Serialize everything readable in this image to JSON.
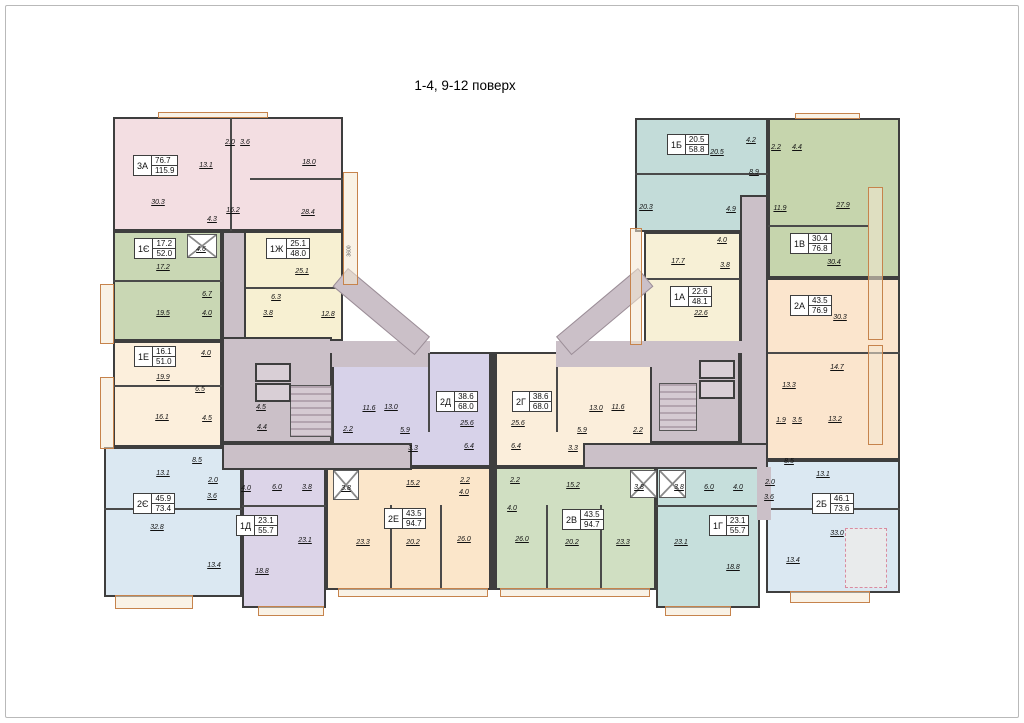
{
  "title": "1-4, 9-12 поверх",
  "palette": {
    "walls": "#3e3e3e",
    "corridor": "#cbc0c8",
    "balcony_outline": "#c6834c",
    "background": "#ffffff",
    "apt_3A": "#f3dee2",
    "apt_1E_ye": "#c9d7b4",
    "apt_1Zh": "#f7f0d2",
    "apt_1E": "#fcefdc",
    "apt_2E_ye": "#dbe8f2",
    "apt_1D": "#dcd4e8",
    "apt_2E": "#fbe6ca",
    "apt_2D": "#d7d2e9",
    "apt_2G": "#fbeedb",
    "apt_2V": "#d0dfc2",
    "apt_1G": "#c6dfdc",
    "apt_2B": "#dbe8f2",
    "apt_1B": "#c3dcd9",
    "apt_1V": "#c6d5ad",
    "apt_1A": "#f7f0d6",
    "apt_2A": "#fbe5cd"
  },
  "corridor": {
    "left_labels": [
      "4.5",
      "4.4"
    ]
  },
  "dimensions": {
    "vertical": "3600"
  },
  "apartments": [
    {
      "code": "3А",
      "area1": "76.7",
      "area2": "115.9",
      "color": "#f3dee2",
      "rooms": [
        "30.3",
        "13.1",
        "2.0",
        "3.6",
        "18.0",
        "16.2",
        "4.3",
        "28.4"
      ]
    },
    {
      "code": "1Є",
      "area1": "17.2",
      "area2": "52.0",
      "color": "#c9d7b4",
      "rooms": [
        "17.2",
        "4.6",
        "6.7",
        "19.5",
        "4.0"
      ]
    },
    {
      "code": "1Ж",
      "area1": "25.1",
      "area2": "48.0",
      "color": "#f7f0d2",
      "rooms": [
        "25.1",
        "6.3",
        "3.8",
        "12.8"
      ]
    },
    {
      "code": "1Е",
      "area1": "16.1",
      "area2": "51.0",
      "color": "#fcefdc",
      "rooms": [
        "4.0",
        "19.9",
        "6.5",
        "16.1",
        "4.5"
      ]
    },
    {
      "code": "2Є",
      "area1": "45.9",
      "area2": "73.4",
      "color": "#dbe8f2",
      "rooms": [
        "8.5",
        "13.1",
        "2.0",
        "3.6",
        "32.8",
        "13.4"
      ]
    },
    {
      "code": "1Д",
      "area1": "23.1",
      "area2": "55.7",
      "color": "#dcd4e8",
      "rooms": [
        "4.0",
        "6.0",
        "3.8",
        "23.1",
        "18.8"
      ]
    },
    {
      "code": "2Е",
      "area1": "43.5",
      "area2": "94.7",
      "color": "#fbe6ca",
      "rooms": [
        "3.8",
        "15.2",
        "2.2",
        "4.0",
        "23.3",
        "20.2",
        "26.0"
      ]
    },
    {
      "code": "2Д",
      "area1": "38.6",
      "area2": "68.0",
      "color": "#d7d2e9",
      "rooms": [
        "11.6",
        "13.0",
        "2.2",
        "5.9",
        "3.3",
        "25.6",
        "6.4"
      ]
    },
    {
      "code": "2Г",
      "area1": "38.6",
      "area2": "68.0",
      "color": "#fbeedb",
      "rooms": [
        "25.6",
        "6.4",
        "5.9",
        "3.3",
        "13.0",
        "11.6",
        "2.2"
      ]
    },
    {
      "code": "2В",
      "area1": "43.5",
      "area2": "94.7",
      "color": "#d0dfc2",
      "rooms": [
        "2.2",
        "4.0",
        "26.0",
        "15.2",
        "20.2",
        "23.3",
        "3.8"
      ]
    },
    {
      "code": "1Г",
      "area1": "23.1",
      "area2": "55.7",
      "color": "#c6dfdc",
      "rooms": [
        "3.8",
        "6.0",
        "4.0",
        "23.1",
        "18.8"
      ]
    },
    {
      "code": "2Б",
      "area1": "46.1",
      "area2": "73.6",
      "color": "#dbe8f2",
      "rooms": [
        "8.5",
        "13.1",
        "2.0",
        "3.6",
        "33.0",
        "13.4"
      ]
    },
    {
      "code": "1Б",
      "area1": "20.5",
      "area2": "58.8",
      "color": "#c3dcd9",
      "rooms": [
        "20.5",
        "4.2",
        "8.9",
        "20.3",
        "4.9"
      ]
    },
    {
      "code": "1В",
      "area1": "30.4",
      "area2": "76.8",
      "color": "#c6d5ad",
      "rooms": [
        "2.2",
        "4.4",
        "11.9",
        "27.9",
        "30.4"
      ]
    },
    {
      "code": "1А",
      "area1": "22.6",
      "area2": "48.1",
      "color": "#f7f0d6",
      "rooms": [
        "17.7",
        "4.0",
        "3.8",
        "22.6"
      ]
    },
    {
      "code": "2А",
      "area1": "43.5",
      "area2": "76.9",
      "color": "#fbe5cd",
      "rooms": [
        "30.3",
        "14.7",
        "13.3",
        "1.9",
        "3.5",
        "13.2"
      ]
    }
  ]
}
